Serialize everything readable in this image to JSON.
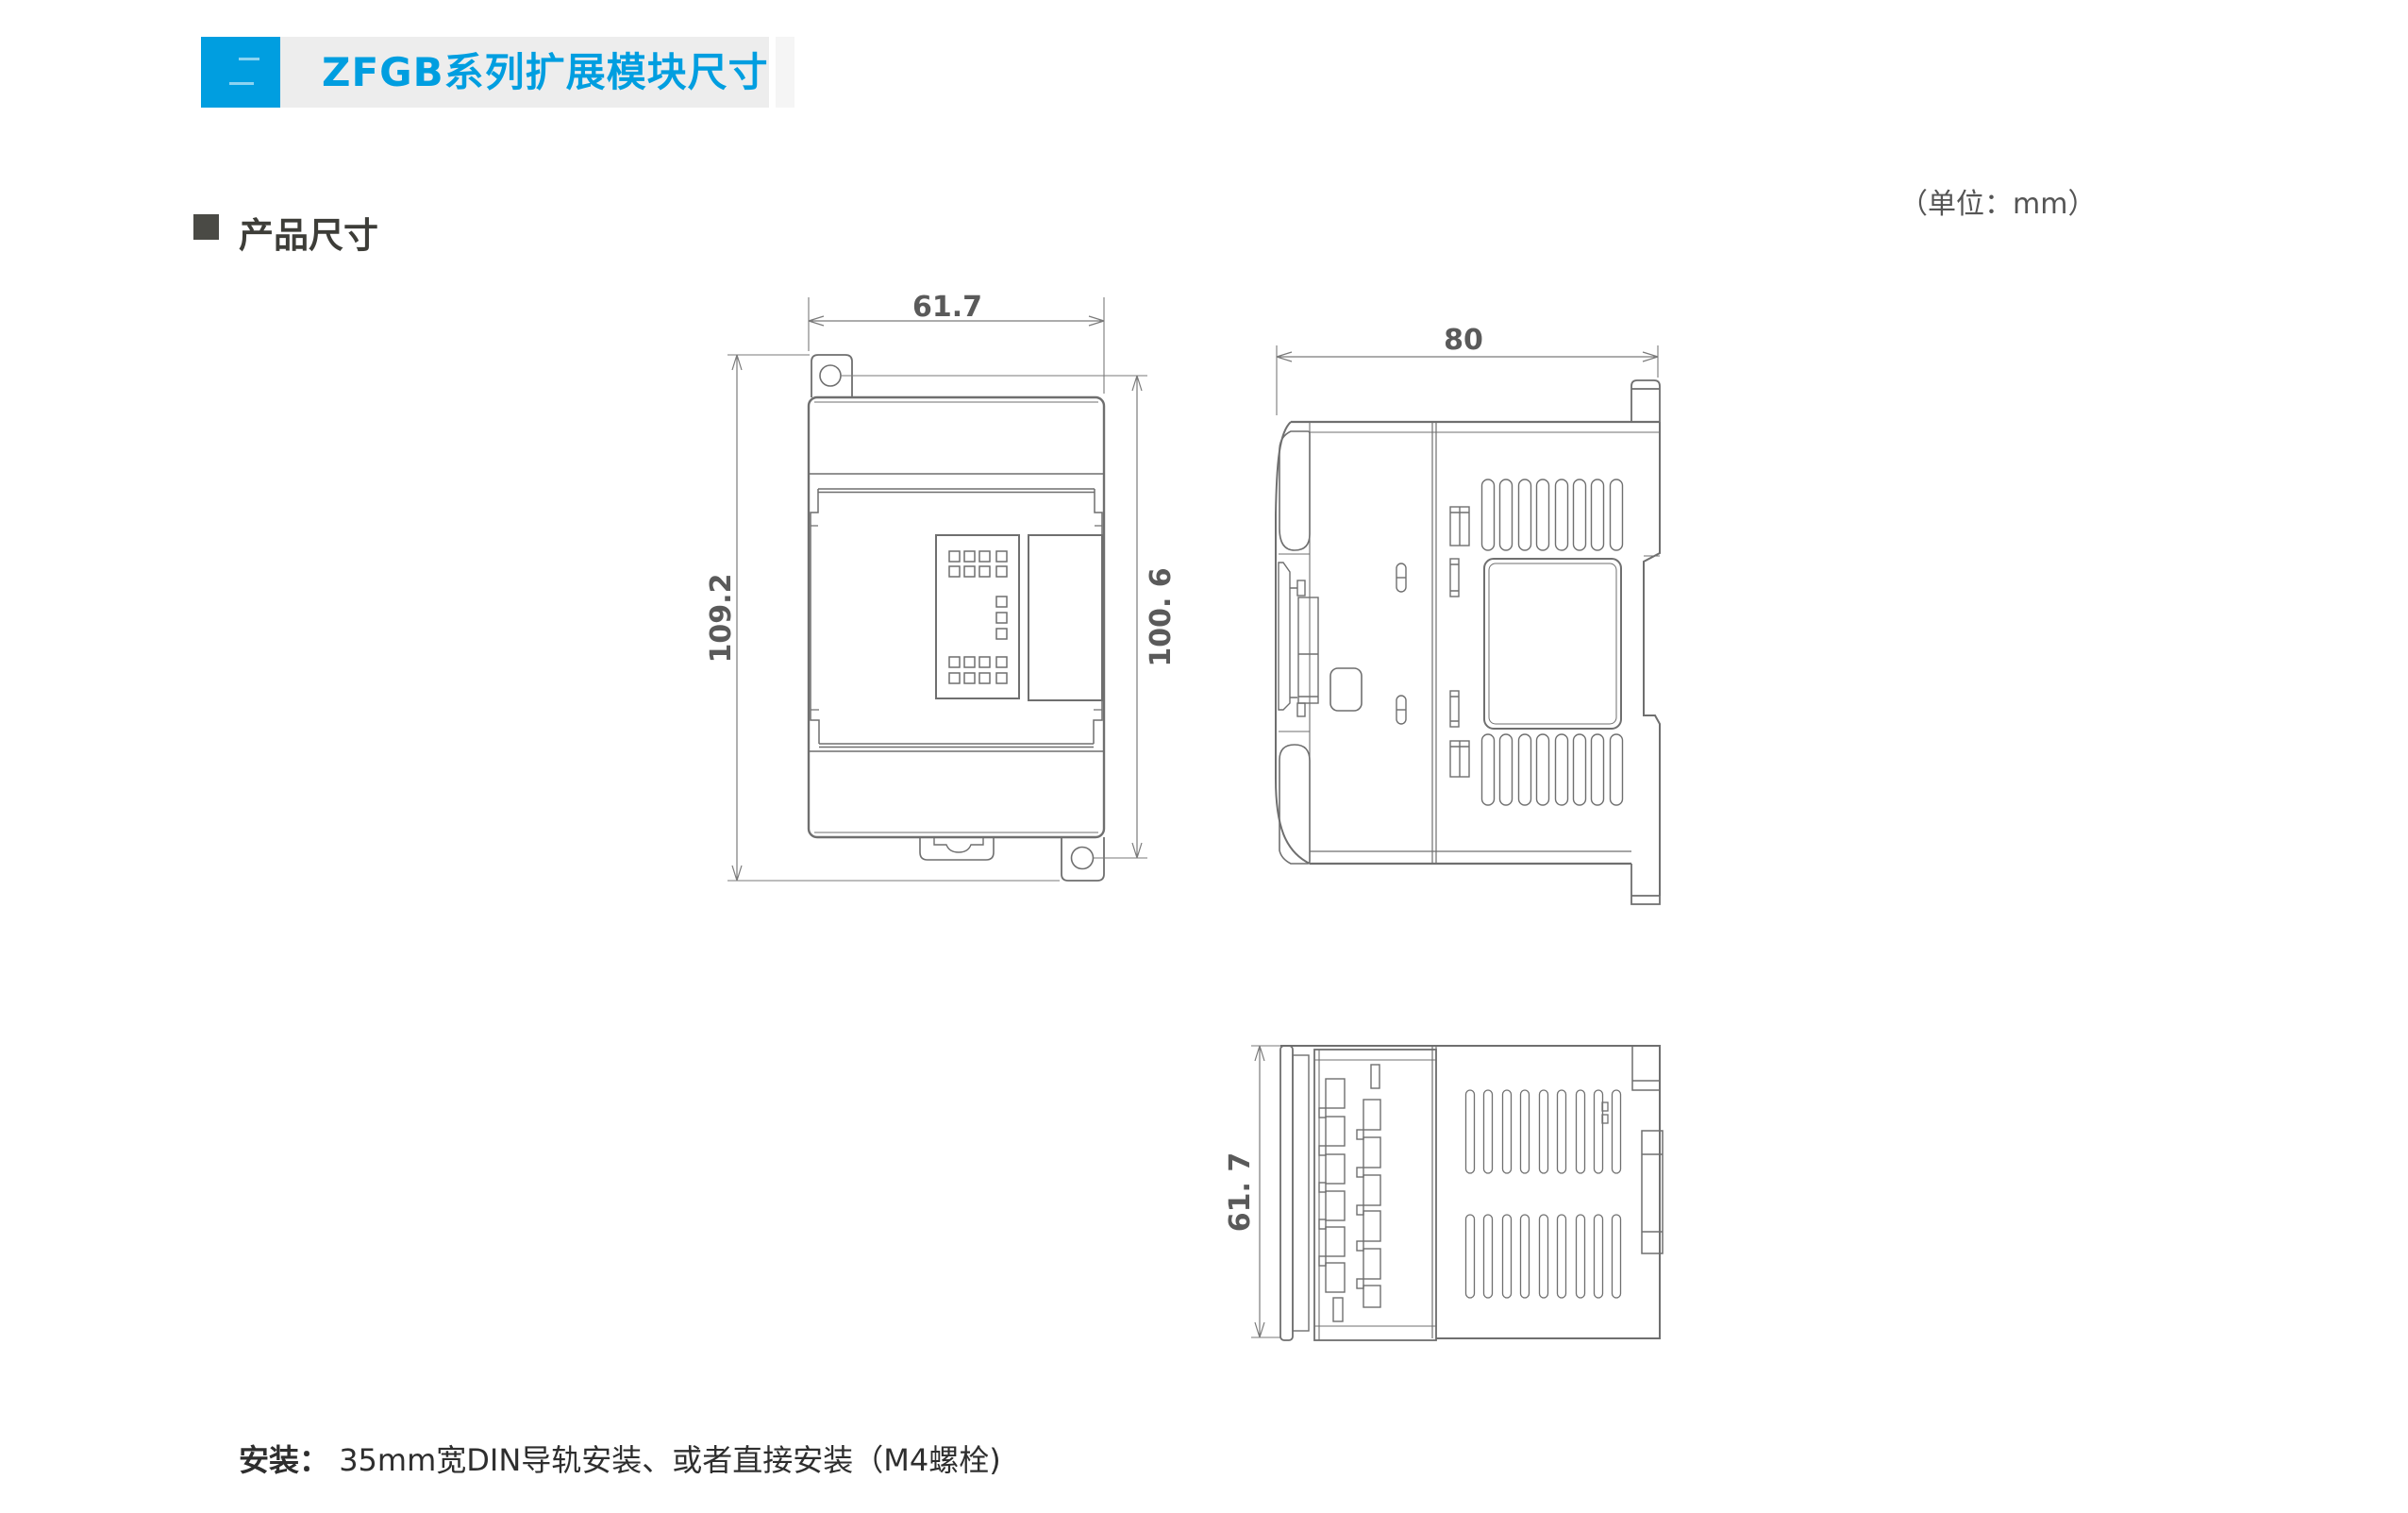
{
  "header": {
    "title": "ZFGB系列扩展模块尺寸",
    "accent_color": "#009EE0",
    "bar_color": "#EDEDED"
  },
  "section": {
    "title": "产品尺寸"
  },
  "units_note": "（单位：mm）",
  "drawings": {
    "front_view": {
      "width": "61.7",
      "overall_height": "109.2",
      "hole_pitch": "100. 6"
    },
    "side_view": {
      "depth": "80"
    },
    "bottom_view": {
      "width": "61. 7"
    }
  },
  "footer": {
    "label": "安装：",
    "text": "35mm宽DIN导轨安装、或者直接安装（M4螺栓)"
  }
}
